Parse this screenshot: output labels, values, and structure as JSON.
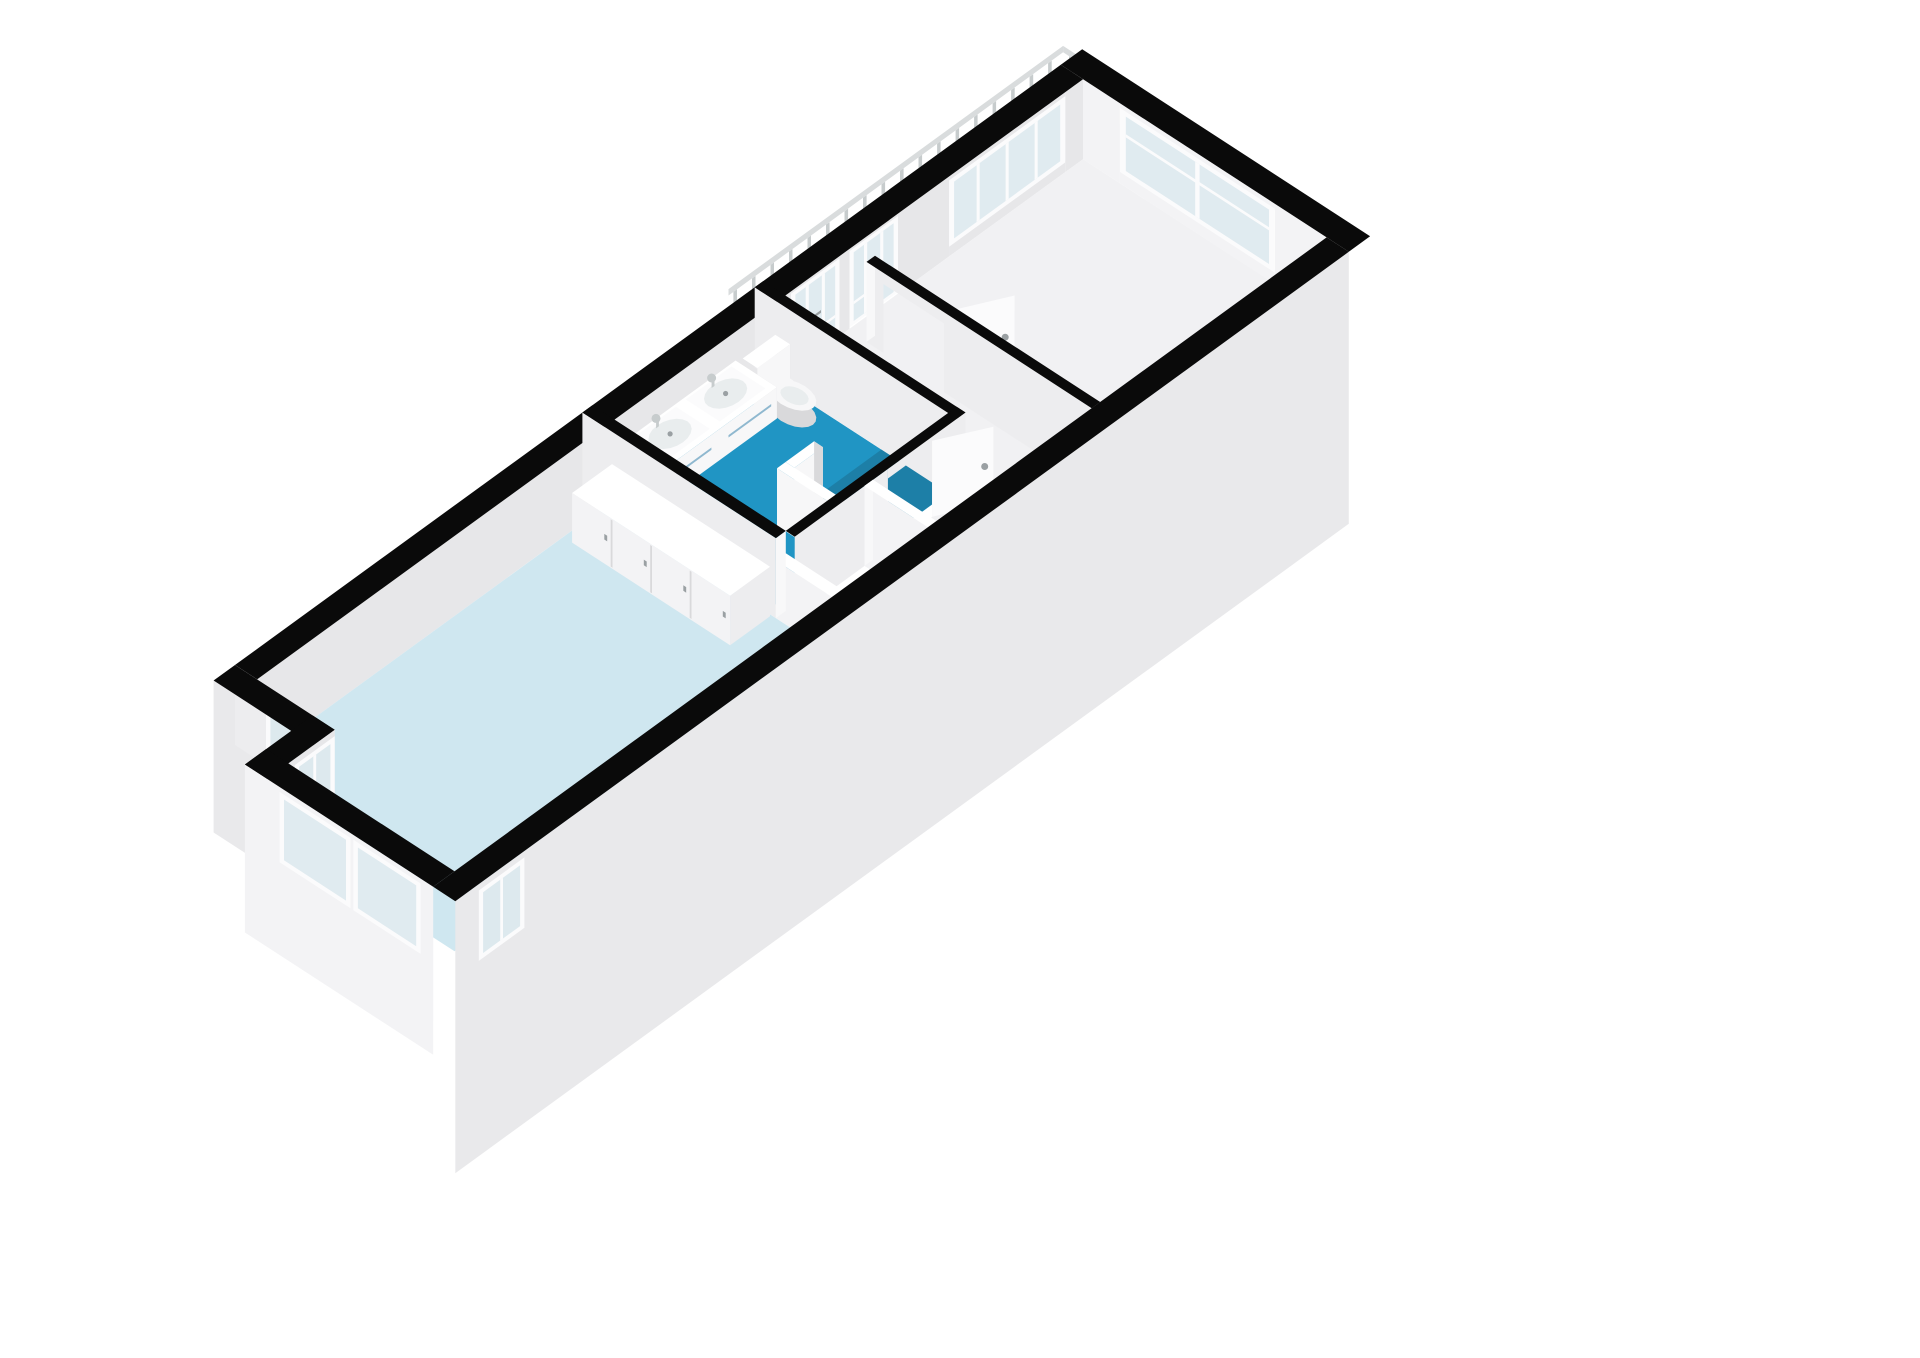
{
  "title": "3d-floorplan",
  "palette": {
    "background": "#ffffff",
    "wall_cut": "#0a0a0a",
    "wall_face": "#e7e7e9",
    "wall_face_bright": "#f3f3f5",
    "wall_face_mid": "#ededef",
    "wall_cap": "#f8f8f9",
    "outer_skirt": "#e9e9eb",
    "bedroom_floor": "#cfe7f0",
    "bathroom_floor": "#2095c4",
    "shower_floor": "#1d7fa7",
    "hall_floor": "#f1f1f3",
    "glass_opaque": "#dde9ee",
    "glass_alpha": "rgba(213,229,235,0.72)",
    "frame_white": "#fbfbfc",
    "fixture_white": "#f7f7f8",
    "fixture_top": "#ffffff",
    "fixture_shade": "#d9d9db",
    "step_top": "#f5f5f6",
    "step_riser": "#dfdfe2",
    "railing_bar": "#d9dcdd",
    "railing_post": "#c7cccd",
    "handle_grey": "#9aa0a3",
    "vanity_handle": "#8fb8cf",
    "basin": "#e9edee",
    "radiator_fin": "#c6c8ca",
    "radiator_body": "#e0e0e2"
  },
  "geometry": {
    "px_per_m": 88,
    "wall_h_px": 80,
    "origin": [
      235,
      745
    ],
    "axis_a": [
      0.809,
      -0.588
    ],
    "axis_b": [
      0.839,
      0.545
    ],
    "building": {
      "length": 11.6,
      "width": 3.9,
      "band": 0.3,
      "skirt_drop": 2.4
    },
    "rooms": {
      "bedroom": [
        0,
        0.3,
        4.88,
        3.6
      ],
      "bedroom_bay_ext": [
        -0.65,
        1.35,
        0,
        3.6
      ],
      "bathroom": [
        5.02,
        0.3,
        7.3,
        2.62
      ],
      "shower": [
        5.95,
        1.72,
        7.3,
        2.62
      ],
      "hall_landing": [
        7.42,
        0.3,
        11.6,
        3.6
      ],
      "stair_hall": [
        6.12,
        2.74,
        7.42,
        3.6
      ]
    },
    "walls": {
      "divider": {
        "u": [
          4.88,
          5.02
        ],
        "v": [
          0,
          2.62
        ],
        "stub_v": [
          2.62,
          3.6
        ],
        "stub_h": 0.72
      },
      "bath_right": {
        "u": [
          7.3,
          7.42
        ],
        "v": [
          0,
          2.74
        ]
      },
      "bath_bottom": {
        "v": [
          2.62,
          2.74
        ],
        "u": [
          5.02,
          7.42
        ],
        "door_u": [
          6.33,
          6.95
        ]
      },
      "hall": {
        "u": [
          8.3,
          8.42
        ],
        "v": [
          0.55,
          3.6
        ],
        "door_v": [
          0.78,
          1.6
        ]
      },
      "stair_flank": {
        "u": [
          6.0,
          6.12
        ],
        "v": [
          2.74,
          3.6
        ]
      }
    },
    "facade_openings": {
      "balcony_door_1": [
        7.5,
        8.18
      ],
      "balcony_door_2": [
        8.32,
        9.0
      ],
      "black_pier": [
        9.0,
        9.72
      ],
      "landing_window": [
        9.72,
        11.35
      ]
    },
    "end_window_v": [
      0.8,
      2.9
    ],
    "niche_window_v": [
      0.42,
      1.08
    ],
    "bay": {
      "front_u": [
        -0.95,
        -0.65
      ],
      "side_v": [
        1.05,
        1.35
      ],
      "front_windows_v": [
        [
          1.58,
          2.42
        ],
        [
          2.58,
          3.37
        ]
      ],
      "side_window_u": [
        -0.5,
        -0.06
      ],
      "bottom_window_u": [
        -0.56,
        -0.04
      ]
    },
    "closet": {
      "rect": [
        4.3,
        0.42,
        4.86,
        2.56
      ],
      "h": 0.62,
      "doors": 4
    },
    "vanity": {
      "rect": [
        5.12,
        0.3,
        6.72,
        0.86
      ],
      "z": [
        0.25,
        0.64
      ],
      "sinks": [
        [
          5.2,
          0.34,
          5.84,
          0.8
        ],
        [
          5.98,
          0.34,
          6.62,
          0.8
        ]
      ]
    },
    "toilet": {
      "cistern": [
        6.82,
        0.3,
        7.28,
        0.5
      ],
      "cistern_h": 0.6,
      "bowl_c": [
        7.05,
        0.76
      ],
      "bowl_r": [
        0.17,
        0.27
      ],
      "bowl_h": 0.27
    },
    "shower_partition": {
      "main": [
        5.83,
        1.72,
        5.95,
        2.62
      ],
      "stub": [
        5.95,
        1.72,
        6.35,
        1.84
      ],
      "h": 0.72,
      "drain_c": [
        6.78,
        2.17
      ],
      "drain_r_px": 11
    },
    "stairs": {
      "u": [
        5.04,
        5.98
      ],
      "v0": 2.78,
      "n": 5,
      "depth": 0.165,
      "drop": 0.16,
      "z0": -0.03
    },
    "radiator": {
      "rect": [
        8.95,
        3.2,
        10.15,
        3.36
      ],
      "h": 0.45,
      "fins": 9,
      "tabs": 6
    },
    "railing": {
      "v": -0.5,
      "u": [
        7.45,
        12.15
      ],
      "return_u": 12.15,
      "return_v": [
        -0.5,
        1.35
      ],
      "rail_z": [
        0.5,
        0.58
      ],
      "bal_w": 0.05,
      "step": 0.26
    },
    "door_leaves": {
      "bathroom": {
        "from": [
          6.95,
          2.74
        ],
        "to": [
          7.5,
          3.04
        ],
        "h": 0.95,
        "handle": [
          7.42,
          3.0,
          0.48
        ]
      },
      "landing": {
        "from": [
          8.42,
          1.6
        ],
        "to": [
          8.98,
          1.9
        ],
        "h": 0.95,
        "handle": [
          8.9,
          1.85,
          0.45
        ]
      }
    }
  }
}
